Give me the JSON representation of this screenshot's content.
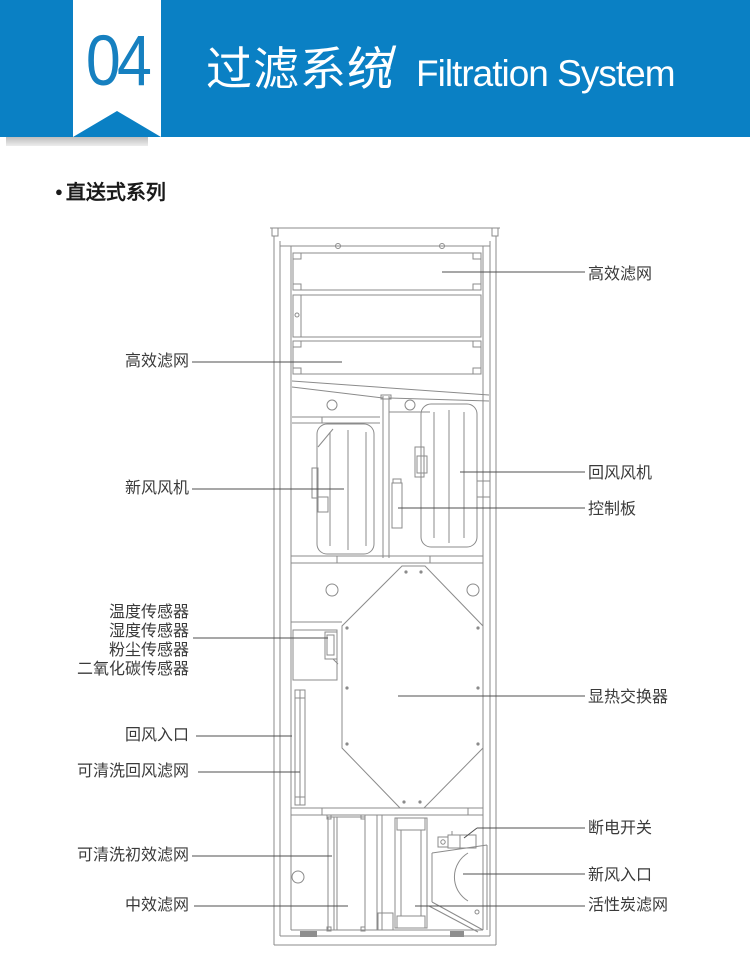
{
  "colors": {
    "header_blue": "#0a80c4",
    "badge_text_blue": "#1680c0",
    "label_text": "#3a3a3a",
    "drawing_line_gray": "#8b8b8b",
    "callout_line_gray": "#4f4f4f"
  },
  "header": {
    "badge_number": "04",
    "title_zh": "过滤系统",
    "separator": "/",
    "title_en": "Filtration System"
  },
  "section": {
    "bullet": "●",
    "title": "直送式系列"
  },
  "diagram": {
    "labels_left": [
      {
        "text": "高效滤网",
        "y": 362
      },
      {
        "text": "新风风机",
        "y": 489
      },
      {
        "text": "温度传感器",
        "y": 613
      },
      {
        "text": "湿度传感器",
        "y": 632
      },
      {
        "text": "粉尘传感器",
        "y": 651
      },
      {
        "text": "二氧化碳传感器",
        "y": 670
      },
      {
        "text": "回风入口",
        "y": 736
      },
      {
        "text": "可清洗回风滤网",
        "y": 772
      },
      {
        "text": "可清洗初效滤网",
        "y": 856
      },
      {
        "text": "中效滤网",
        "y": 906
      }
    ],
    "labels_right": [
      {
        "text": "高效滤网",
        "y": 275
      },
      {
        "text": "回风风机",
        "y": 474
      },
      {
        "text": "控制板",
        "y": 510
      },
      {
        "text": "显热交换器",
        "y": 698
      },
      {
        "text": "断电开关",
        "y": 829
      },
      {
        "text": "新风入口",
        "y": 876
      },
      {
        "text": "活性炭滤网",
        "y": 906
      }
    ],
    "callouts_left": [
      {
        "x1": 192,
        "y1": 362,
        "x2": 342,
        "y2": 362
      },
      {
        "x1": 192,
        "y1": 489,
        "x2": 344,
        "y2": 489
      },
      {
        "x1": 193,
        "y1": 638,
        "x2": 328,
        "y2": 638
      },
      {
        "x1": 196,
        "y1": 736,
        "x2": 292,
        "y2": 736
      },
      {
        "x1": 198,
        "y1": 772,
        "x2": 300,
        "y2": 772
      },
      {
        "x1": 192,
        "y1": 856,
        "x2": 332,
        "y2": 856
      },
      {
        "x1": 194,
        "y1": 906,
        "x2": 348,
        "y2": 906
      }
    ],
    "callouts_right": [
      {
        "x1": 442,
        "y1": 272,
        "x2": 585,
        "y2": 272
      },
      {
        "x1": 460,
        "y1": 472,
        "x2": 585,
        "y2": 472
      },
      {
        "x1": 398,
        "y1": 508,
        "x2": 585,
        "y2": 508
      },
      {
        "x1": 398,
        "y1": 696,
        "x2": 585,
        "y2": 696
      },
      {
        "x1": 477,
        "y1": 828,
        "x2": 585,
        "y2": 828
      },
      {
        "x1": 477,
        "y1": 828,
        "x2": 464,
        "y2": 838
      },
      {
        "x1": 463,
        "y1": 874,
        "x2": 585,
        "y2": 874
      },
      {
        "x1": 415,
        "y1": 906,
        "x2": 585,
        "y2": 906
      }
    ]
  }
}
